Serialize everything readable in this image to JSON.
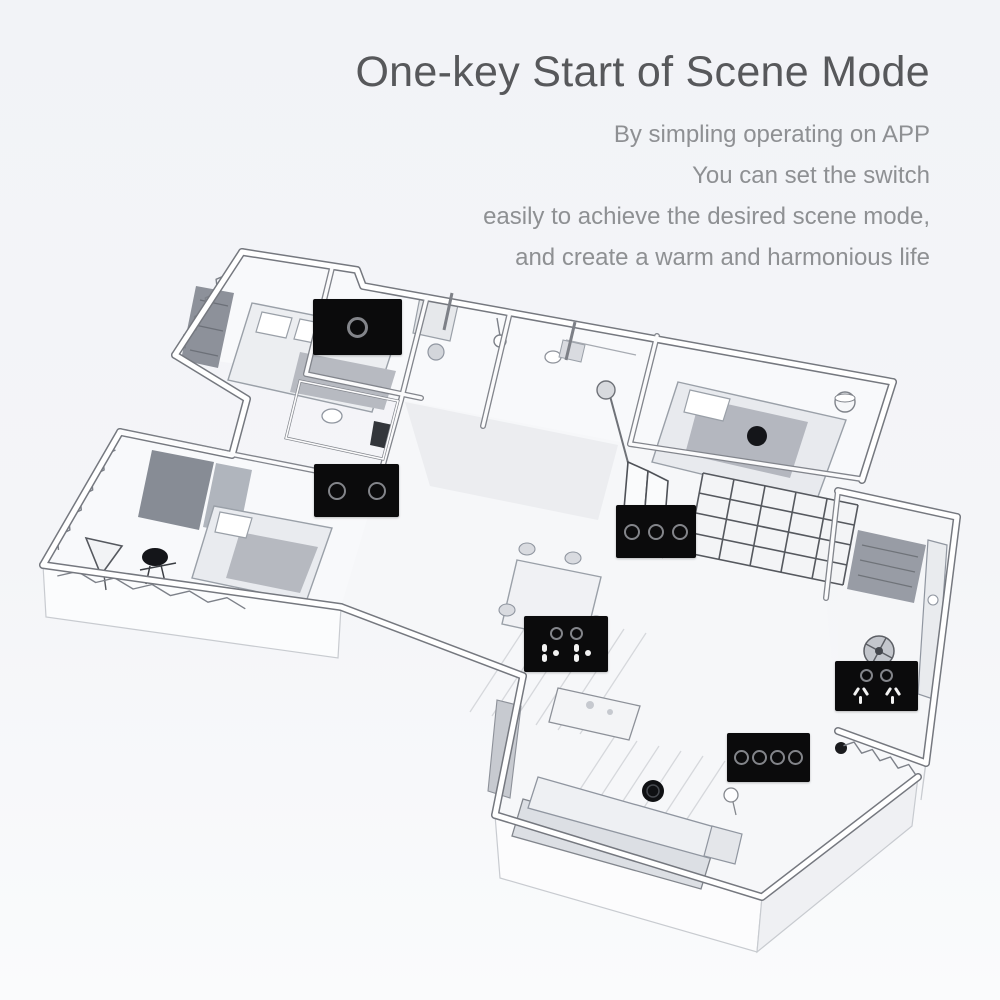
{
  "header": {
    "title": "One-key Start of Scene Mode",
    "subtitle_lines": [
      "By simpling operating on APP",
      "You can set the switch",
      "easily to achieve the desired scene mode,",
      "and create a warm and harmonious life"
    ]
  },
  "colors": {
    "background": "#f4f5f8",
    "title_text": "#57585b",
    "subtitle_text": "#8e9093",
    "panel_black": "#0b0b0c",
    "ring_gray": "#83858a",
    "sketch_line": "#75787f"
  },
  "floorplan": {
    "description": "Hand-drawn isometric cutaway sketch of an apartment with smart wall switches placed in each room",
    "rooms": [
      "bedroom",
      "bathroom",
      "study",
      "dining room",
      "kitchen",
      "living room"
    ],
    "devices": [
      {
        "id": "switch-1gang-top-bedroom",
        "label": "1-gang touch scene switch",
        "gangs": 1,
        "x": 313,
        "y": 299,
        "w": 89,
        "h": 56
      },
      {
        "id": "switch-2gang-left-bedroom",
        "label": "2-gang touch scene switch",
        "gangs": 2,
        "x": 314,
        "y": 464,
        "w": 85,
        "h": 53
      },
      {
        "id": "switch-3gang-study",
        "label": "3-gang touch scene switch",
        "gangs": 3,
        "x": 616,
        "y": 505,
        "w": 80,
        "h": 53
      },
      {
        "id": "socket-switch-dining",
        "label": "2-gang switch with power socket",
        "gangs": 2,
        "sockets": "dots",
        "x": 524,
        "y": 616,
        "w": 84,
        "h": 56
      },
      {
        "id": "socket-switch-kitchen",
        "label": "2-gang switch with power socket",
        "gangs": 2,
        "sockets": "slots",
        "x": 835,
        "y": 661,
        "w": 83,
        "h": 50
      },
      {
        "id": "switch-4gang-living",
        "label": "4-gang touch scene switch",
        "gangs": 4,
        "x": 727,
        "y": 733,
        "w": 83,
        "h": 49
      }
    ]
  }
}
